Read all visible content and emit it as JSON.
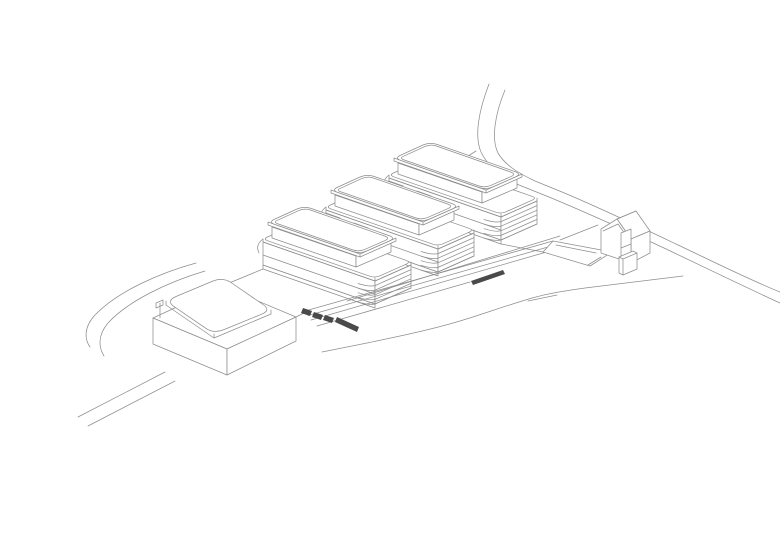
{
  "canvas": {
    "width": 780,
    "height": 551,
    "background": "#ffffff"
  },
  "palette": {
    "line": "#8e8e8e",
    "dark": "#4a4a4a",
    "white": "#ffffff"
  },
  "drawing": {
    "title": "site-axonometric-line-drawing",
    "slab_building_template": {
      "paths": [
        {
          "d": "M -5,43 L 107,82 L 107,86 L -5,47 Z",
          "f": "white"
        },
        {
          "d": "M -5,20 L 107,59 L 107,82 L -5,43 Z",
          "f": "white"
        },
        {
          "d": "M -5,33 L 107,72"
        },
        {
          "d": "M 107,59 L 143,43 L 143,66 L 107,82 Z",
          "f": "white"
        },
        {
          "d": "M 107,63.6 L 143,47.6 M 107,68.2 L 143,52.2 M 107,72.8 L 143,56.8 M 107,77.4 L 143,61.4 M 107,82 L 143,66"
        },
        {
          "d": "M 90,61.5 Q 101,65 107,63.6 M 90,66.1 Q 101,69.6 107,68.2 M 90,70.7 Q 101,74.2 107,72.8 M 90,75.3 Q 101,78.8 107,77.4 M 90,80 Q 101,83.4 107,82"
        },
        {
          "d": "M -0.5,15 L 26,3.2 Q 31,1 36.2,2.8 L 138,38.3 Q 143,40 137.8,42.3 L 112,53.8 Q 107,56 101.8,54.2 L -0.3,18.8 Q -5,17 -0.5,15 Z",
          "f": "white"
        },
        {
          "d": "M -5,20 L 107,59 L 143,43 M -5,17 L -5,20 M 107,56 L 107,59 M 143,40 L 143,43"
        },
        {
          "d": "M 4,5 L 88,34 L 88,45 L 4,16 Z",
          "f": "white"
        },
        {
          "d": "M 88,34 L 123,19 L 123,30 L 88,45 Z",
          "f": "white"
        },
        {
          "d": "M 0,0 L 0,3 L 92,35 L 128,19 L 128,16 L 92,32 Z",
          "f": "white"
        },
        {
          "d": "M 92,32 L 92,35"
        },
        {
          "d": "M 7,-3 L 29,-13 Q 36,-16 43,-13.6 L 121,13.6 Q 128,16 121.2,19 L 99.2,28.7 Q 92,32 85,29.5 L 7,2.5 Q 0,0 7,-3 Z",
          "f": "white"
        },
        {
          "d": "M 10.5,-2.2 L 30.5,-11.3 Q 36.6,-14 42.7,-11.9 L 116.6,14 Q 122.6,16.1 116.7,18.7 L 97,27.3 Q 90.8,30 84.7,27.9 L 10.4,2 Q 4.3,0 10.5,-2.2 Z"
        },
        {
          "d": "M -5,17 Q -13,23 -9,31"
        }
      ]
    },
    "slab_buildings": [
      {
        "name": "slab-building-1",
        "x": 394,
        "y": 158
      },
      {
        "name": "slab-building-2",
        "x": 331,
        "y": 190
      },
      {
        "name": "slab-building-3",
        "x": 268,
        "y": 222
      }
    ],
    "groups": [
      {
        "name": "main-road",
        "paths": [
          {
            "d": "M 489,84 C 479,110 474,136 481,152 C 488,167 502,177 519,185 L 549,197 C 585,212 625,230 664,248 C 706,268 745,287 780,303"
          },
          {
            "d": "M 505,90 C 495,114 491,139 498,153 C 505,165 518,173 535,181 L 562,192 C 598,207 638,226 676,244 C 714,262 750,280 780,292"
          },
          {
            "d": "M 476,151 L 448,169"
          }
        ]
      },
      {
        "name": "hillside-terrain",
        "paths": [
          {
            "d": "M 501,244 L 543,252"
          },
          {
            "d": "M 560,240 L 598,225"
          },
          {
            "d": "M 222,286 L 263,269"
          },
          {
            "d": "M 227,349 L 268,331"
          }
        ]
      },
      {
        "name": "connector-boxes-gap-1",
        "paths": [
          {
            "d": "M 371,189 L 389,181 L 403,186 L 385,194 Z",
            "f": "white"
          },
          {
            "d": "M 385,194 L 403,186 L 403,194 L 385,202 Z",
            "f": "white"
          },
          {
            "d": "M 399,199 L 417,191 L 431,196 L 413,204 Z",
            "f": "white"
          },
          {
            "d": "M 413,204 L 431,196 L 431,204 L 413,212 Z",
            "f": "white"
          }
        ]
      },
      {
        "name": "connector-boxes-gap-2",
        "paths": [
          {
            "d": "M 308,221 L 326,213 L 340,218 L 322,226 Z",
            "f": "white"
          },
          {
            "d": "M 322,226 L 340,218 L 340,226 L 322,234 Z",
            "f": "white"
          },
          {
            "d": "M 336,231 L 354,223 L 368,228 L 350,236 Z",
            "f": "white"
          },
          {
            "d": "M 350,236 L 368,228 L 368,236 L 350,244 Z",
            "f": "white"
          }
        ]
      },
      {
        "name": "promenade-ramp",
        "paths": [
          {
            "d": "M 347,301 L 560,236"
          },
          {
            "d": "M 305,311 L 553,241"
          },
          {
            "d": "M 308,315.5 L 555,245"
          },
          {
            "d": "M 311,320 L 557,249"
          },
          {
            "d": "M 317,326 L 470,282"
          },
          {
            "d": "M 553,241 L 612,252 L 590,266 L 543,252 Z",
            "f": "white"
          },
          {
            "d": "M 556,245 L 596,253"
          },
          {
            "d": "M 296,317 L 306,312"
          }
        ]
      },
      {
        "name": "stair-hatch-strips",
        "paths": [
          {
            "d": "M 303,308 L 312,311 L 310,316 L 301,313 Z",
            "f": "dark"
          },
          {
            "d": "M 314,312 L 323,315 L 321,320 L 312,317 Z",
            "f": "dark"
          },
          {
            "d": "M 325,315 L 334,318 L 332,323 L 323,320 Z",
            "f": "dark"
          },
          {
            "d": "M 337,317 L 359,327 L 357,332 L 335,322 Z",
            "f": "dark"
          },
          {
            "d": "M 471,281 L 503,270 L 505,274 L 473,285 Z",
            "f": "dark"
          }
        ]
      },
      {
        "name": "left-road",
        "paths": [
          {
            "d": "M 196,263 C 160,273 118,291 95,315 C 83,328 85,340 90,347"
          },
          {
            "d": "M 205,271 C 168,282 128,301 108,323 C 97,336 99,348 104,356"
          }
        ]
      },
      {
        "name": "podium-building",
        "paths": [
          {
            "d": "M 153,318 L 222,286 L 296,317 L 227,349 Z",
            "f": "white"
          },
          {
            "d": "M 153,318 L 227,349 L 227,375 L 153,344 Z",
            "f": "white"
          },
          {
            "d": "M 227,349 L 296,317 L 296,341 L 227,375 Z",
            "f": "white"
          },
          {
            "d": "M 160,318 L 160,303 M 156,303 L 163,300 L 163,305 L 156,308 Z"
          },
          {
            "d": "M 166,305 L 214,338 L 271,314 M 166,301 L 166,305 M 214,334 L 214,338 M 271,310 L 271,314"
          },
          {
            "d": "M 176,296.5 L 213,281 Q 223,277 231,282.5 L 263,304.5 Q 271,310 262.5,313.8 L 225.5,329 Q 214,334 206,328.4 L 174,306.6 Q 166,301 176,296.5 Z",
            "f": "white"
          }
        ]
      },
      {
        "name": "footpath",
        "paths": [
          {
            "d": "M 165,372 L 78,417"
          },
          {
            "d": "M 175,381 L 88,426"
          }
        ]
      },
      {
        "name": "bottom-road",
        "paths": [
          {
            "d": "M 322,352 L 367,343 C 400,336 430,330 460,321 C 480,315 505,306 532,298 C 550,293 565,291 585,288 L 683,276"
          },
          {
            "d": "M 528,301 L 557,295"
          }
        ]
      },
      {
        "name": "gabled-house",
        "paths": [
          {
            "d": "M 617,219 L 636,211 L 650,231 L 631,239 Z",
            "f": "white"
          },
          {
            "d": "M 631,239 L 650,231 L 650,253 L 631,263 Z",
            "f": "white"
          },
          {
            "d": "M 617,219 L 601,229 L 601,253 L 631,263 L 631,239 Z",
            "f": "white"
          },
          {
            "d": "M 603,231 L 618,224 L 630,241"
          },
          {
            "d": "M 617,219 L 636,211"
          },
          {
            "d": "M 621,233 L 631,229 L 631,262 L 621,266 Z",
            "f": "white"
          },
          {
            "d": "M 621,248 L 631,244"
          },
          {
            "d": "M 619,257 L 633,251 L 637,253 L 637,269 L 623,275 L 619,273 Z",
            "f": "white"
          },
          {
            "d": "M 623,259 L 623,275 M 619,257 L 623,259 L 637,253"
          },
          {
            "d": "M 588,265 L 601,257"
          }
        ]
      }
    ]
  }
}
